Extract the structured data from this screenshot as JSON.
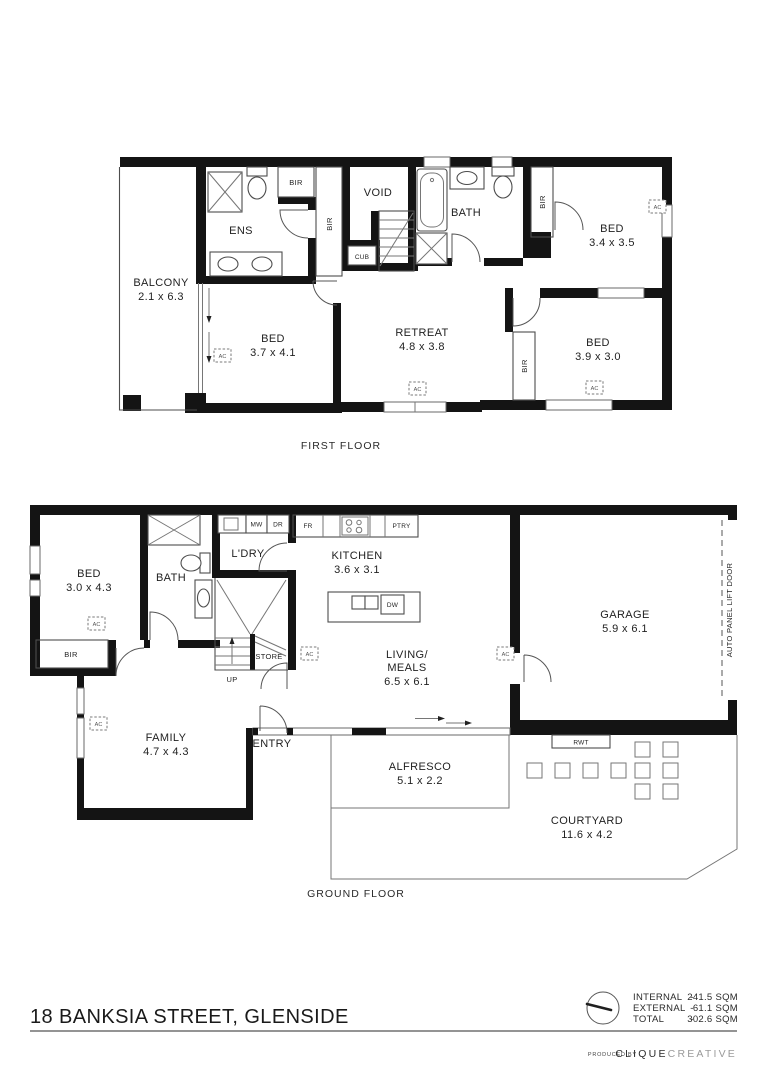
{
  "first_floor": {
    "label": "FIRST FLOOR",
    "rooms": {
      "balcony": {
        "name": "BALCONY",
        "dims": "2.1 x 6.3"
      },
      "ens": {
        "name": "ENS"
      },
      "bed1": {
        "name": "BED",
        "dims": "3.7 x 4.1"
      },
      "void": {
        "name": "VOID"
      },
      "retreat": {
        "name": "RETREAT",
        "dims": "4.8 x 3.8"
      },
      "bath": {
        "name": "BATH"
      },
      "bed2": {
        "name": "BED",
        "dims": "3.4 x 3.5"
      },
      "bed3": {
        "name": "BED",
        "dims": "3.9 x 3.0"
      }
    }
  },
  "ground_floor": {
    "label": "GROUND FLOOR",
    "rooms": {
      "bed": {
        "name": "BED",
        "dims": "3.0 x 4.3"
      },
      "bath": {
        "name": "BATH"
      },
      "ldry": {
        "name": "L'DRY"
      },
      "kitchen": {
        "name": "KITCHEN",
        "dims": "3.6 x 3.1"
      },
      "living": {
        "line1": "LIVING/",
        "line2": "MEALS",
        "dims": "6.5 x 6.1"
      },
      "family": {
        "name": "FAMILY",
        "dims": "4.7 x 4.3"
      },
      "garage": {
        "name": "GARAGE",
        "dims": "5.9 x 6.1"
      },
      "alfresco": {
        "name": "ALFRESCO",
        "dims": "5.1 x 2.2"
      },
      "courtyard": {
        "name": "COURTYARD",
        "dims": "11.6 x 4.2"
      },
      "entry": {
        "name": "ENTRY"
      },
      "store": {
        "name": "STORE"
      }
    },
    "garage_door_label": "AUTO PANEL LIFT DOOR"
  },
  "markers": {
    "ac": "AC",
    "bir": "BIR",
    "cub": "CUB",
    "up": "UP",
    "mw": "MW",
    "dr": "DR",
    "fr": "FR",
    "ptry": "PTRY",
    "dw": "DW",
    "rwt": "RWT"
  },
  "footer": {
    "address": "18 BANKSIA STREET, GLENSIDE",
    "areas": [
      {
        "label": "INTERNAL",
        "value": "241.5 SQM"
      },
      {
        "label": "EXTERNAL",
        "value": "61.1 SQM"
      },
      {
        "label": "TOTAL",
        "value": "302.6 SQM"
      }
    ],
    "dash": "-",
    "produced_by": "PRODUCED BY",
    "brand_bold": "CLIQUE",
    "brand_light": "CREATIVE"
  },
  "colors": {
    "wall": "#141414",
    "line": "#4d4d4d",
    "accent_gray": "#9a9a9a"
  }
}
